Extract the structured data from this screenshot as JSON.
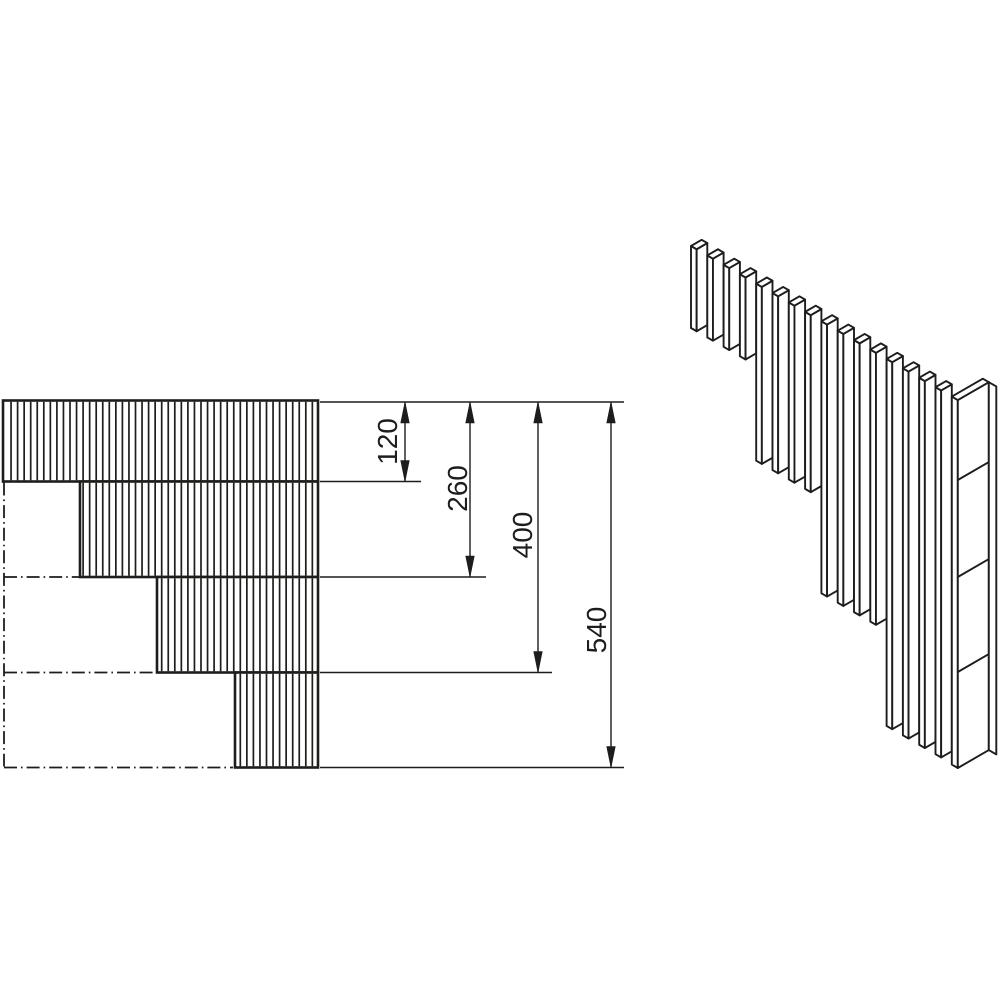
{
  "figure": {
    "title": "corner-detail-technical-drawing",
    "background": "#ffffff",
    "ink": "#1d1d1b",
    "canvas": {
      "width": 1000,
      "height": 1000
    }
  },
  "dimensions": {
    "unit_scale_px_per_mm": 0.681,
    "lines": [
      {
        "label": "120",
        "line_x": 405,
        "top_y": 402,
        "bottom_y": 481.5,
        "ext_right": 421,
        "label_x": 397,
        "label_y": 441.5
      },
      {
        "label": "260",
        "line_x": 470,
        "top_y": 402,
        "bottom_y": 577,
        "ext_right": 486,
        "label_x": 467,
        "label_y": 488.5
      },
      {
        "label": "400",
        "line_x": 538,
        "top_y": 402,
        "bottom_y": 672.5,
        "ext_right": 552,
        "label_x": 532,
        "label_y": 535
      },
      {
        "label": "540",
        "line_x": 611,
        "top_y": 402,
        "bottom_y": 767.5,
        "ext_right": 624,
        "label_x": 606,
        "label_y": 630
      }
    ],
    "top_extension": {
      "y": 402,
      "x1": 320,
      "x2": 624
    },
    "bottom_extension": {
      "y": 767.5,
      "x1": 320,
      "x2": 624
    },
    "font_size": 28,
    "arrow_length": 21,
    "arrow_half_width": 4.3
  },
  "elevation": {
    "right_x": 318,
    "levels_y": [
      400.5,
      481.5,
      577,
      672.5,
      767.5
    ],
    "band_left_x": [
      3,
      80,
      157,
      235
    ],
    "hatch_start_x": 4.5,
    "hatch_spacing": 6.55,
    "centerline_x": 4,
    "centerline_dash": "13 4 1.6 4"
  },
  "isometric": {
    "origin_x": 691,
    "origin_y": 246,
    "pitch_x": 16.3,
    "strip_w": 5.65,
    "slope": 0.5774,
    "slat_count": 16,
    "group_counts": [
      4,
      4,
      4,
      4
    ],
    "group_heights_px": [
      82,
      177,
      272,
      367
    ],
    "post": {
      "strip_w": 6,
      "wide_w": 31,
      "right_strip_w": 7.5,
      "joint_levels_y": [
        480,
        577,
        672
      ],
      "bottom_y": 768
    }
  }
}
